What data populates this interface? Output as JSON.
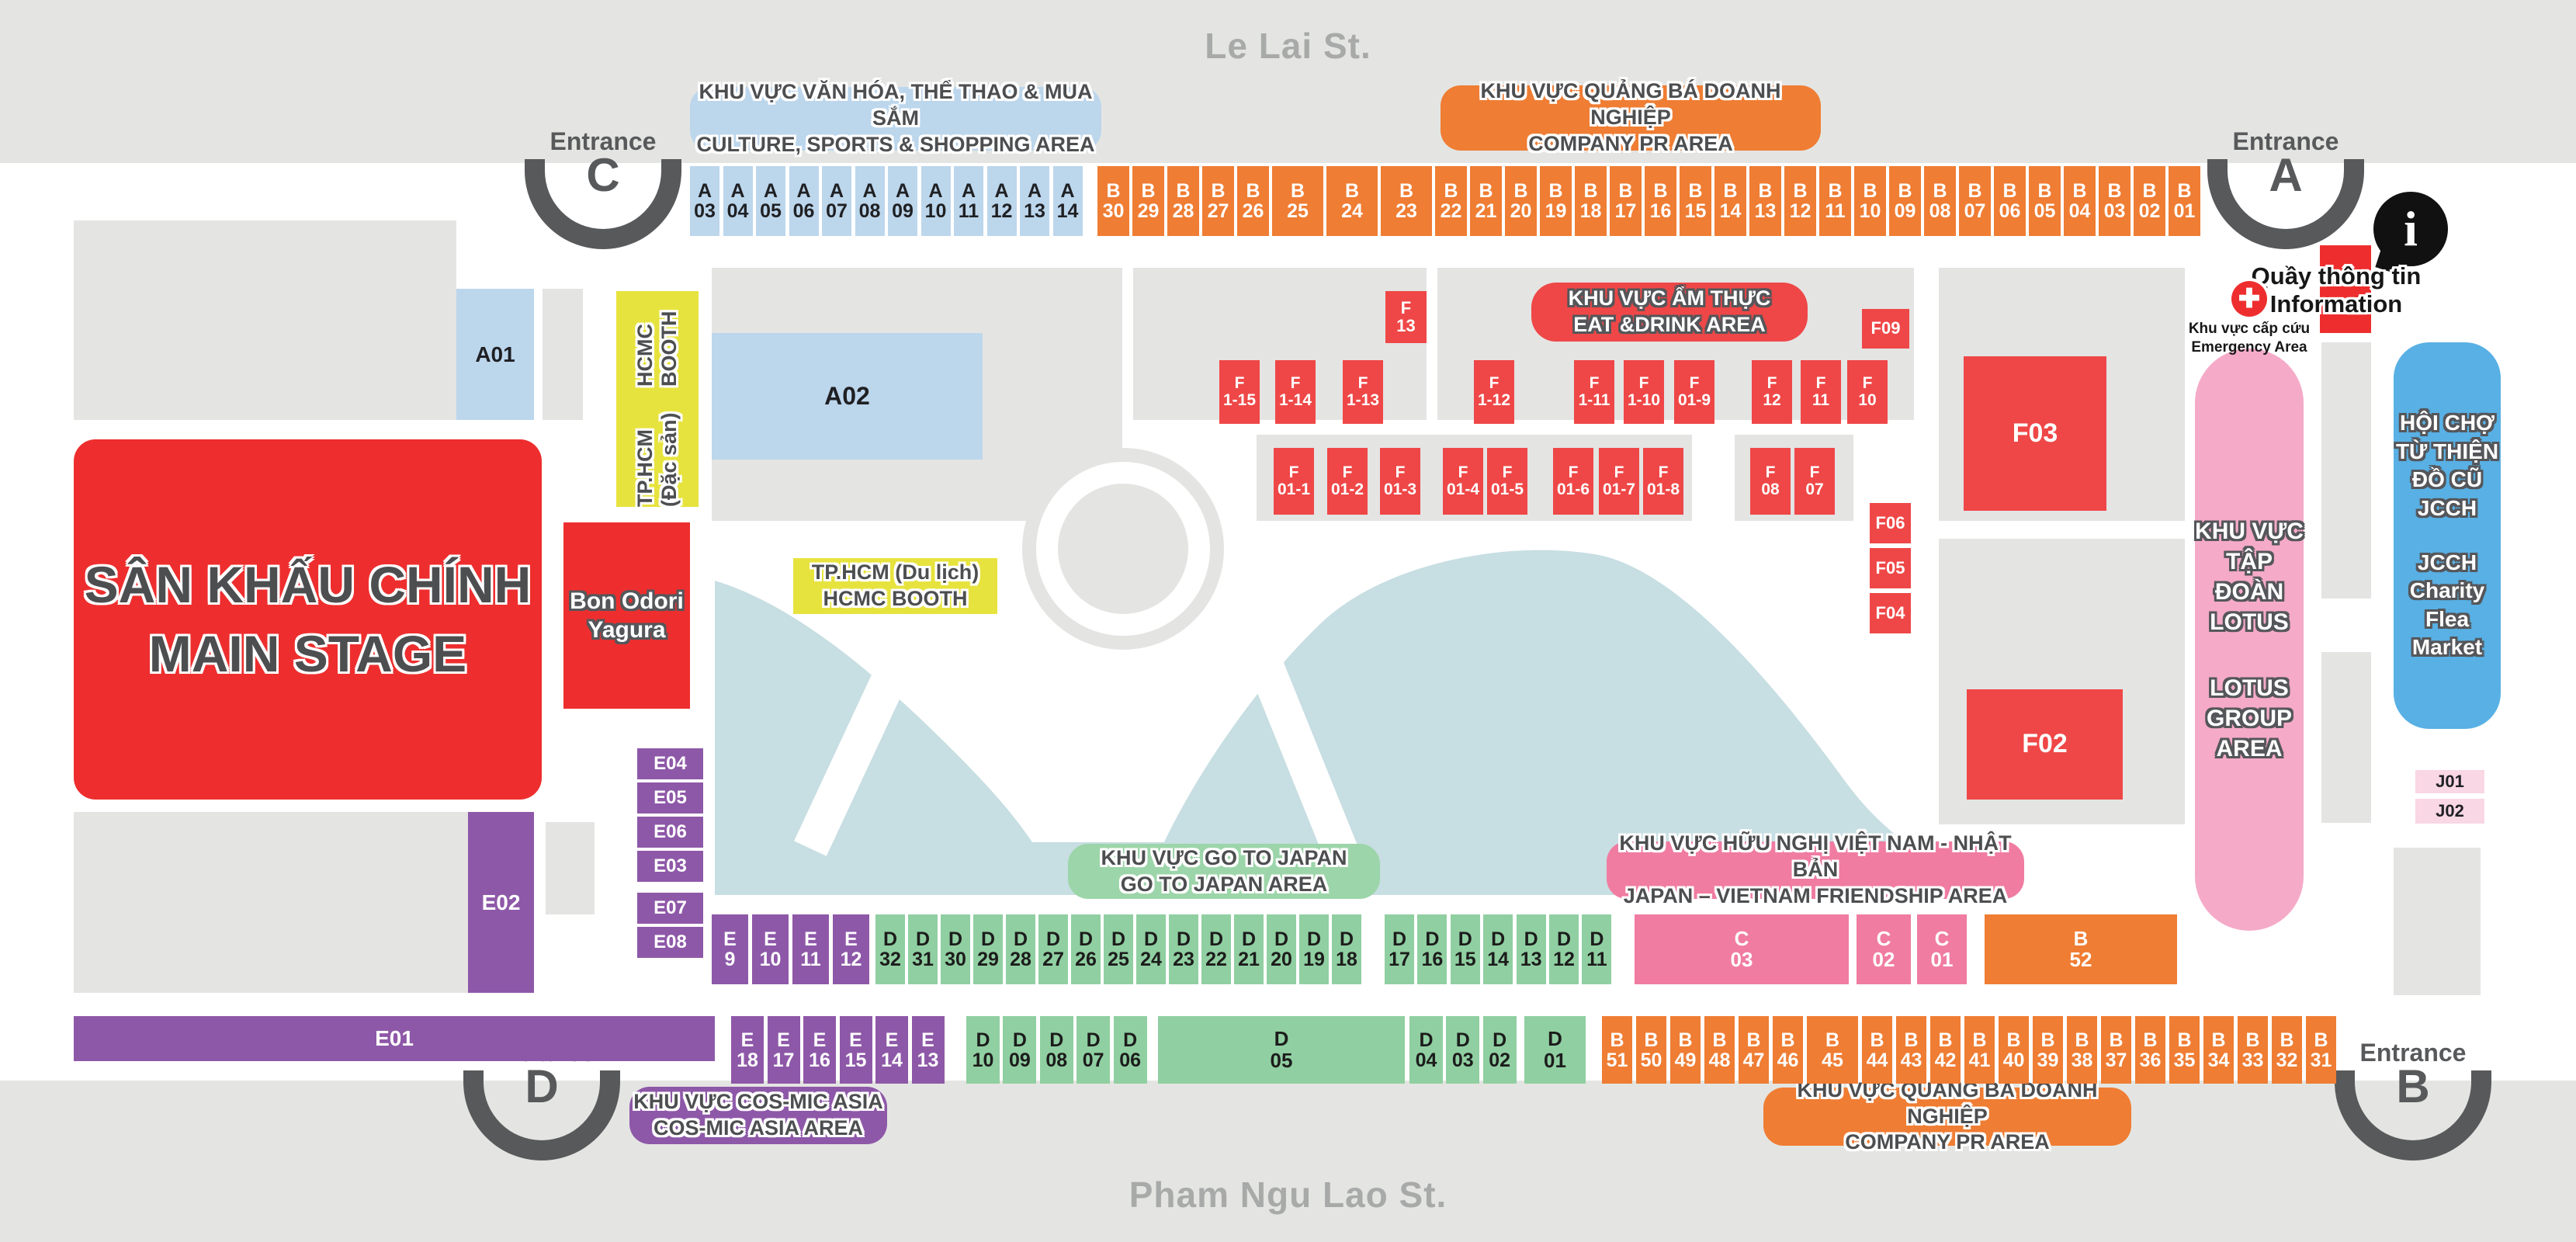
{
  "streets": {
    "top": "Le Lai St.",
    "bottom": "Pham Ngu Lao St."
  },
  "entrances": {
    "a": {
      "word": "Entrance",
      "letter": "A"
    },
    "b": {
      "word": "Entrance",
      "letter": "B"
    },
    "c": {
      "word": "Entrance",
      "letter": "C"
    },
    "d": {
      "word": "Entrance",
      "letter": "D"
    }
  },
  "labels": {
    "culture": {
      "l1": "KHU VỰC VĂN HÓA, THỂ THAO & MUA SẮM",
      "l2": "CULTURE, SPORTS & SHOPPING AREA"
    },
    "pr_top": {
      "l1": "KHU VỰC QUẢNG BÁ DOANH NGHIỆP",
      "l2": "COMPANY PR AREA"
    },
    "pr_bottom": {
      "l1": "KHU VỰC QUẢNG BÁ DOANH NGHIỆP",
      "l2": "COMPANY PR AREA"
    },
    "eat": {
      "l1": "KHU VỰC ẨM THỰC",
      "l2": "EAT &DRINK AREA"
    },
    "gojapan": {
      "l1": "KHU VỰC GO TO JAPAN",
      "l2": "GO TO JAPAN AREA"
    },
    "friendship": {
      "l1": "KHU VỰC HỮU NGHỊ VIỆT NAM - NHẬT BẢN",
      "l2": "JAPAN – VIETNAM FRIENDSHIP AREA"
    },
    "cosmic": {
      "l1": "KHU VỰC COS-MIC ASIA",
      "l2": "COS-MIC ASIA AREA"
    },
    "info": {
      "l1": "Quầy thông tin",
      "l2": "Information"
    },
    "emergency": {
      "l1": "Khu vực cấp cứu",
      "l2": "Emergency Area"
    }
  },
  "zones": {
    "main_stage": {
      "l1": "SÂN KHẤU CHÍNH",
      "l2": "MAIN STAGE"
    },
    "bon_odori": {
      "l1": "Bon Odori",
      "l2": "Yagura"
    },
    "hcmc_dacsan": {
      "l1": "TP.HCM (Đặc sản)",
      "l2": "HCMC BOOTH"
    },
    "hcmc_dulich": {
      "l1": "TP.HCM (Du lịch)",
      "l2": "HCMC BOOTH"
    },
    "lotus": {
      "l1": "KHU VỰC",
      "l2": "TẬP ĐOÀN",
      "l3": "LOTUS",
      "l4": "LOTUS",
      "l5": "GROUP",
      "l6": "AREA"
    },
    "jcch": {
      "l1": "HỘI CHỢ",
      "l2": "TỪ THIỆN",
      "l3": "ĐỒ CŨ",
      "l4": "JCCH",
      "l5": "JCCH",
      "l6": "Charity",
      "l7": "Flea",
      "l8": "Market"
    },
    "a01": "A01",
    "a02": "A02",
    "e01": "E01",
    "e02": "E02",
    "f03": "F03",
    "f02": "F02",
    "f13_l1": "F",
    "f13_l2": "13",
    "f09": "F09",
    "f06": "F06",
    "f05": "F05",
    "f04": "F04",
    "j01": "J01",
    "j02": "J02",
    "c03_l1": "C",
    "c03_l2": "03",
    "c02_l1": "C",
    "c02_l2": "02",
    "c01_l1": "C",
    "c01_l2": "01",
    "b52_l1": "B",
    "b52_l2": "52",
    "d05_l1": "D",
    "d05_l2": "05",
    "d01_l1": "D",
    "d01_l2": "01"
  },
  "booths": {
    "row_a": [
      "03",
      "04",
      "05",
      "06",
      "07",
      "08",
      "09",
      "10",
      "11",
      "12",
      "13",
      "14"
    ],
    "row_b_top": [
      "30",
      "29",
      "28",
      "27",
      "26",
      "25",
      "24",
      "23",
      "22",
      "21",
      "20",
      "19",
      "18",
      "17",
      "16",
      "15",
      "14",
      "13",
      "12",
      "11",
      "10",
      "09",
      "08",
      "07",
      "06",
      "05",
      "04",
      "03",
      "02",
      "01"
    ],
    "e_col": [
      "E04",
      "E05",
      "E06",
      "E03",
      "E07",
      "E08"
    ],
    "f_row1": [
      [
        "F",
        "1-15"
      ],
      [
        "F",
        "1-14"
      ],
      [
        "F",
        "1-13"
      ],
      [
        "F",
        "1-12"
      ],
      [
        "F",
        "1-11"
      ],
      [
        "F",
        "1-10"
      ],
      [
        "F",
        "01-9"
      ],
      [
        "F",
        "12"
      ],
      [
        "F",
        "11"
      ],
      [
        "F",
        "10"
      ]
    ],
    "f_row2": [
      [
        "F",
        "01-1"
      ],
      [
        "F",
        "01-2"
      ],
      [
        "F",
        "01-3"
      ],
      [
        "F",
        "01-4"
      ],
      [
        "F",
        "01-5"
      ],
      [
        "F",
        "01-6"
      ],
      [
        "F",
        "01-7"
      ],
      [
        "F",
        "01-8"
      ],
      [
        "F",
        "08"
      ],
      [
        "F",
        "07"
      ]
    ],
    "row1_e": [
      "9",
      "10",
      "11",
      "12"
    ],
    "row1_d_a": [
      "32",
      "31",
      "30",
      "29",
      "28",
      "27",
      "26",
      "25",
      "24",
      "23",
      "22",
      "21",
      "20",
      "19",
      "18"
    ],
    "row1_d_b": [
      "17",
      "16",
      "15",
      "14",
      "13",
      "12",
      "11"
    ],
    "row2_e": [
      "18",
      "17",
      "16",
      "15",
      "14",
      "13"
    ],
    "row2_d_a": [
      "10",
      "09",
      "08",
      "07",
      "06"
    ],
    "row2_d_b": [
      "04",
      "03",
      "02"
    ],
    "row2_b": [
      "51",
      "50",
      "49",
      "48",
      "47",
      "46",
      "45",
      "44",
      "43",
      "42",
      "41",
      "40",
      "39",
      "38",
      "37",
      "36",
      "35",
      "34",
      "33",
      "32",
      "31"
    ]
  },
  "colors": {
    "red": "#ee2e2e",
    "red_booth": "#ef4747",
    "orange": "#ef7d33",
    "blue_booth": "#bcd6ec",
    "blue_jcch": "#58b0e4",
    "green": "#90cfa1",
    "green_label": "#9cd5a9",
    "purple": "#8e58a8",
    "pink_c": "#f07ca2",
    "pink_lotus": "#f5aac8",
    "pink_j": "#f9d7e4",
    "yellow": "#e7e33e",
    "gray_block": "#e4e4e3",
    "gray_band": "#e4e5e2",
    "dark": "#58595b",
    "street": "#a8aaaa",
    "lake": "#c7dee2"
  }
}
